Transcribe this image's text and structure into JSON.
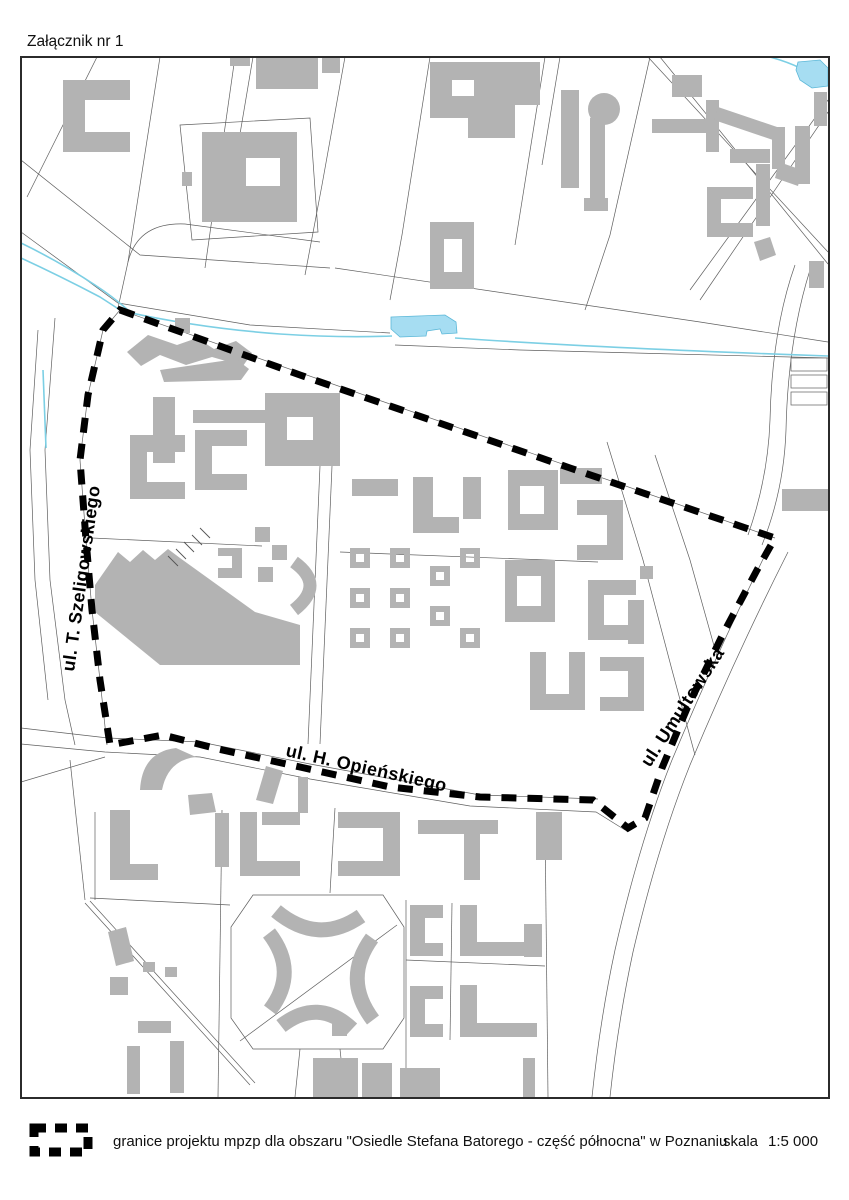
{
  "page": {
    "attachment_label": "Załącznik nr 1"
  },
  "map": {
    "street_labels": [
      {
        "id": "szeligowskiego",
        "text": "ul. T. Szeligowskiego"
      },
      {
        "id": "opienskiego",
        "text": "ul. H. Opieńskiego"
      },
      {
        "id": "umultowska",
        "text": "ul. Umultowska"
      }
    ],
    "colors": {
      "building": "#b3b3b3",
      "water_fill": "#a6ddf2",
      "water_line": "#7ccfe4",
      "boundary": "#000000",
      "frame": "#2b2b2b"
    }
  },
  "legend": {
    "symbol": "dashed-boundary-line",
    "description": "granice projektu mpzp dla obszaru \"Osiedle Stefana Batorego - część północna\" w Poznaniu",
    "scale_label": "skala",
    "scale_value": "1:5 000"
  }
}
